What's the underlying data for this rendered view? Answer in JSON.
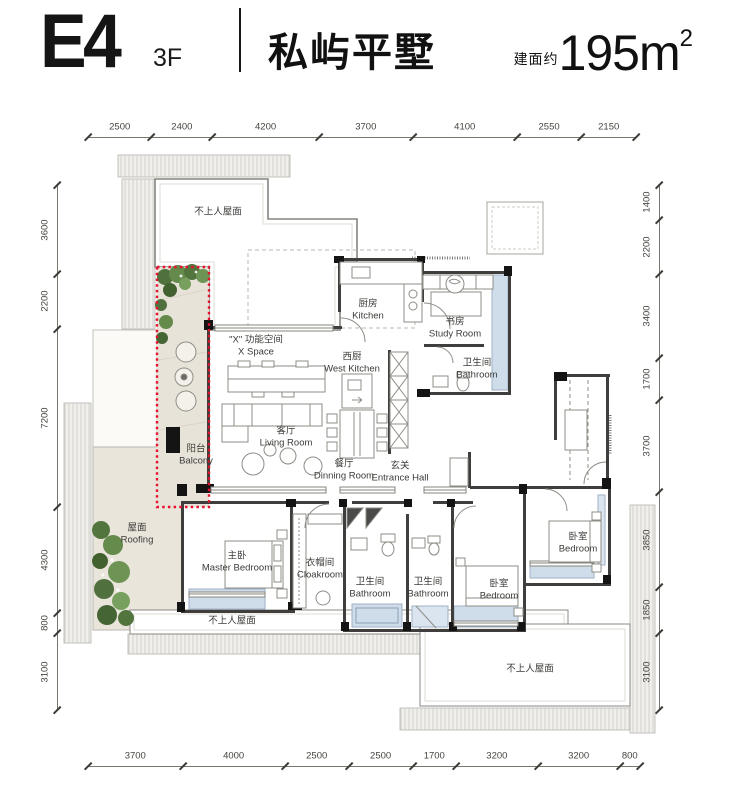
{
  "header": {
    "unit": "E4",
    "floor": "3F",
    "title": "私屿平墅",
    "area_prefix": "建面约",
    "area_number": "195m",
    "area_sup": "2"
  },
  "dimensions": {
    "top": [
      2500,
      2400,
      4200,
      3700,
      4100,
      2550,
      2150
    ],
    "bottom": [
      3700,
      4000,
      2500,
      2500,
      1700,
      3200,
      3200,
      800
    ],
    "left": [
      3600,
      2200,
      7200,
      4300,
      800,
      3100
    ],
    "right": [
      1400,
      2200,
      3400,
      1700,
      3700,
      3850,
      1850,
      3100
    ]
  },
  "rooms": [
    {
      "id": "roof-top",
      "zh": "不上人屋面",
      "en": "",
      "x": 218,
      "y": 212
    },
    {
      "id": "kitchen",
      "zh": "厨房",
      "en": "Kitchen",
      "x": 368,
      "y": 310
    },
    {
      "id": "study",
      "zh": "书房",
      "en": "Study Room",
      "x": 455,
      "y": 328
    },
    {
      "id": "x-space",
      "zh": "\"X\" 功能空间",
      "en": "X Space",
      "x": 256,
      "y": 346
    },
    {
      "id": "west-kitchen",
      "zh": "西厨",
      "en": "West Kitchen",
      "x": 352,
      "y": 363
    },
    {
      "id": "bathroom-top",
      "zh": "卫生间",
      "en": "Bathroom",
      "x": 477,
      "y": 369
    },
    {
      "id": "living-room",
      "zh": "客厅",
      "en": "Living Room",
      "x": 286,
      "y": 437
    },
    {
      "id": "dining-room",
      "zh": "餐厅",
      "en": "Dinning Room",
      "x": 344,
      "y": 470
    },
    {
      "id": "entrance-hall",
      "zh": "玄关",
      "en": "Entrance Hall",
      "x": 400,
      "y": 472
    },
    {
      "id": "balcony",
      "zh": "阳台",
      "en": "Balcony",
      "x": 196,
      "y": 455
    },
    {
      "id": "roofing",
      "zh": "屋面",
      "en": "Roofing",
      "x": 137,
      "y": 534
    },
    {
      "id": "master-bedroom",
      "zh": "主卧",
      "en": "Master Bedroom",
      "x": 237,
      "y": 562
    },
    {
      "id": "cloakroom",
      "zh": "衣帽间",
      "en": "Cloakroom",
      "x": 320,
      "y": 569
    },
    {
      "id": "bathroom-1",
      "zh": "卫生间",
      "en": "Bathroom",
      "x": 370,
      "y": 588
    },
    {
      "id": "bathroom-2",
      "zh": "卫生间",
      "en": "Bathroom",
      "x": 428,
      "y": 588
    },
    {
      "id": "bedroom-mid",
      "zh": "卧室",
      "en": "Bedroom",
      "x": 499,
      "y": 590
    },
    {
      "id": "bedroom-right",
      "zh": "卧室",
      "en": "Bedroom",
      "x": 578,
      "y": 543
    },
    {
      "id": "roof-bottom-left",
      "zh": "不上人屋面",
      "en": "",
      "x": 232,
      "y": 621
    },
    {
      "id": "roof-bottom-right",
      "zh": "不上人屋面",
      "en": "",
      "x": 530,
      "y": 669
    }
  ],
  "colors": {
    "balcony_outline_red": "#e8112d",
    "window_blue": "#cfdcea",
    "plant_green": "#5f8248",
    "deck_beige": "#e8e3d9",
    "wall_dark": "#3f3e3c"
  }
}
